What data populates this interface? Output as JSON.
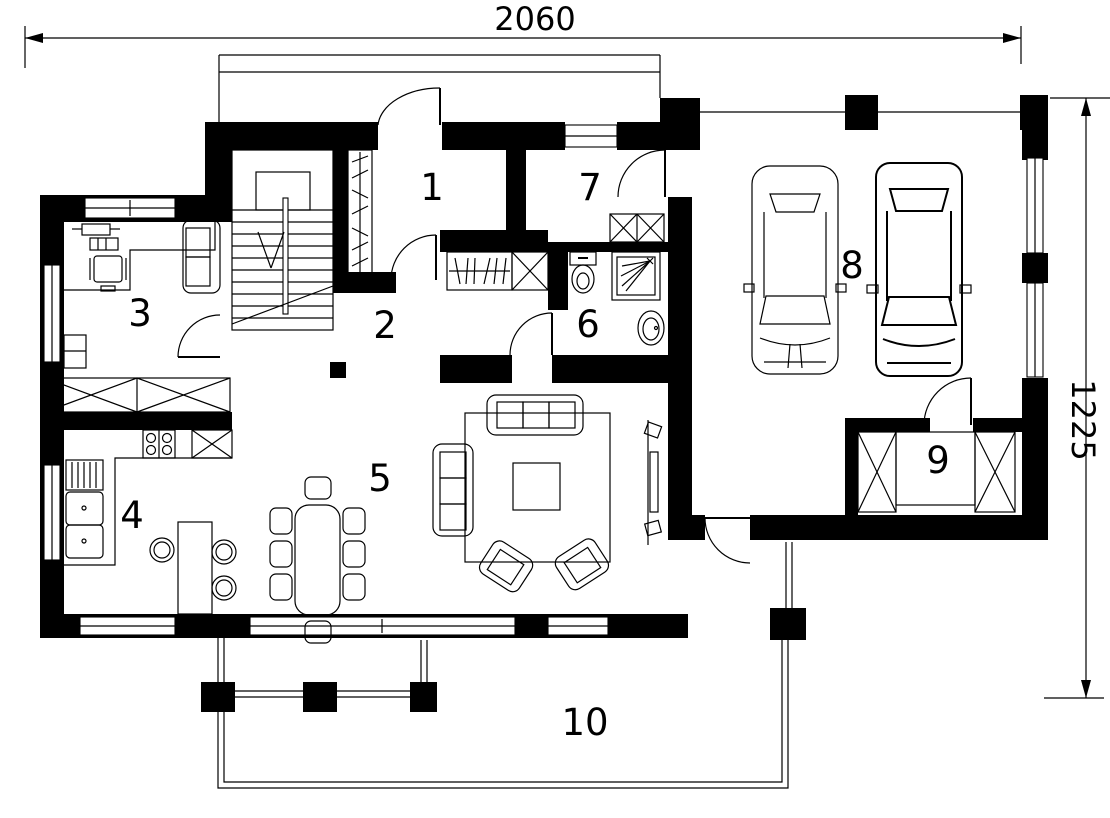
{
  "drawing": {
    "type": "floor-plan",
    "dimensions": {
      "width_label": "2060",
      "height_label": "1225"
    },
    "rooms": [
      {
        "number": "1"
      },
      {
        "number": "2"
      },
      {
        "number": "3"
      },
      {
        "number": "4"
      },
      {
        "number": "5"
      },
      {
        "number": "6"
      },
      {
        "number": "7"
      },
      {
        "number": "8"
      },
      {
        "number": "9"
      },
      {
        "number": "10"
      }
    ],
    "symbols": [
      "staircase",
      "wardrobe",
      "coat-rack",
      "toilet",
      "shower",
      "washbasin",
      "kitchen-sink",
      "dish-rack",
      "stove",
      "refrigerator",
      "kitchen-counter",
      "bar-counter",
      "bar-stool",
      "dining-table",
      "dining-chair",
      "sofa",
      "armchair",
      "coffee-table",
      "rug",
      "tv-unit",
      "desk",
      "office-chair",
      "cabinet",
      "car",
      "terrace-column",
      "railing",
      "window",
      "door"
    ],
    "colors": {
      "walls": "#000000",
      "background": "#ffffff",
      "lines": "#000000"
    }
  }
}
